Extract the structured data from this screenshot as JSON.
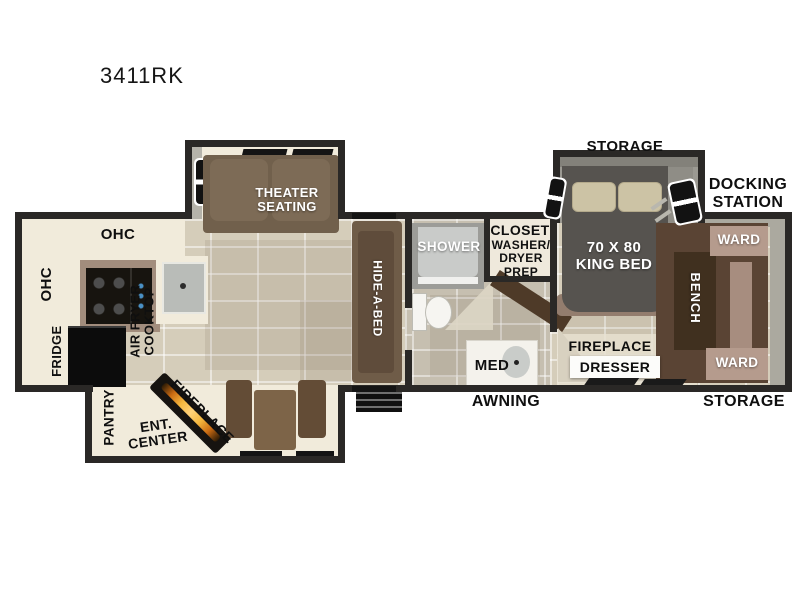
{
  "title": "3411RK",
  "palette": {
    "wall": "#2a2826",
    "floor_tile": "#d5cdba",
    "bath_tile": "#c6bfb0",
    "cabinet_cream": "#f1ebdb",
    "sofa_brown": "#6f5c48",
    "dark_wood": "#40301f",
    "ward_pink": "#b59b8d",
    "bed_charcoal": "#56534f",
    "flame_orange": "#f4b73e"
  },
  "labels": {
    "storage_top": "STORAGE",
    "docking_station": "DOCKING\nSTATION",
    "king_bed": "70 X 80\nKING BED",
    "ward_top": "WARD",
    "bench": "BENCH",
    "ward_bottom": "WARD",
    "fireplace_bedroom": "FIREPLACE",
    "dresser": "DRESSER",
    "storage_bottom": "STORAGE",
    "awning": "AWNING",
    "shower": "SHOWER",
    "closet": "CLOSET",
    "washer_dryer_prep": "WASHER/\nDRYER\nPREP",
    "med": "MED",
    "hide_a_bed": "HIDE-A-BED",
    "theater_seating": "THEATER\nSEATING",
    "ohc_top": "OHC",
    "ohc_left": "OHC",
    "fridge": "FRIDGE",
    "air_fryer_cooktop": "AIR FRYER\nCOOKTOP",
    "pantry": "PANTRY",
    "ent_center": "ENT.\nCENTER",
    "fireplace_living": "FIREPLACE"
  }
}
